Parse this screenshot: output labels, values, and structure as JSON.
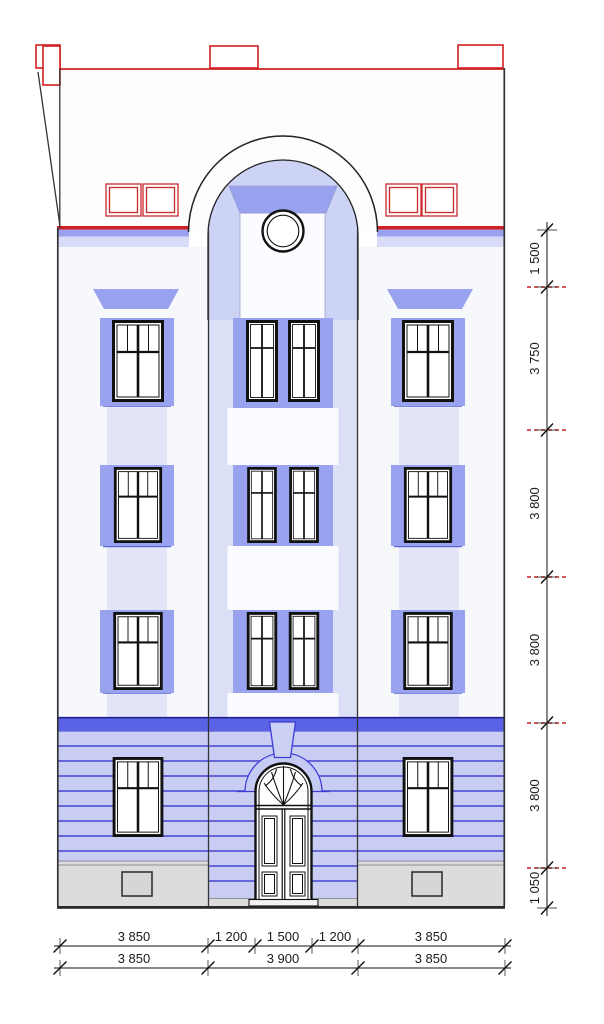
{
  "drawing": {
    "title": "street-facade-elevation",
    "floors_visible": 4
  },
  "dimensions": {
    "right_chain": [
      "1 500",
      "3 750",
      "3 800",
      "3 800",
      "3 800",
      "1 050"
    ],
    "bottom_row1": [
      "3 850",
      "1 200",
      "1 500",
      "1 200",
      "3 850"
    ],
    "bottom_row2": [
      "3 850",
      "3 900",
      "3 850"
    ]
  },
  "colors": {
    "roof_line_red": "#d02020",
    "level_mark_red": "#c52222",
    "window_surround_lavender": "#99a2ee",
    "arch_fill_lavender": "#cdd3f5",
    "center_section_lavender": "#dce0f7",
    "ground_floor_lavender": "#c9cdf4",
    "ground_stripe_blue": "#4444d0",
    "ground_band_blue": "#5a62e6",
    "archivolt_blue": "#3c3cd4",
    "plinth_gray": "#dcdcdc",
    "line_black": "#1a1a1a"
  }
}
